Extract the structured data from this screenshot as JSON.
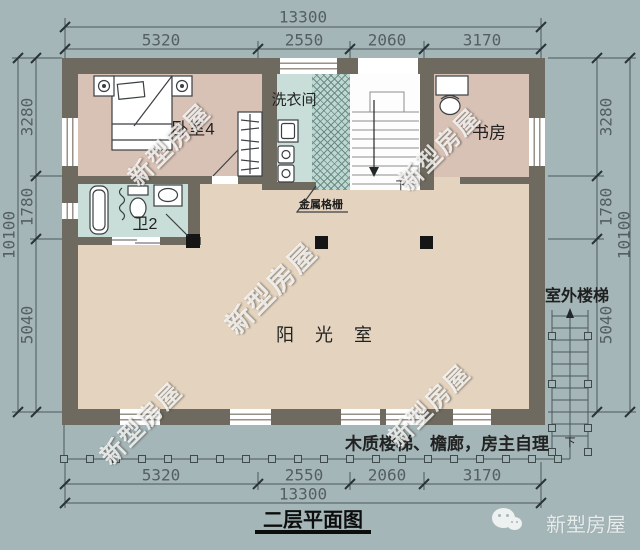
{
  "title": "二层平面图",
  "watermark": "新型房屋",
  "logo": {
    "name": "新型房屋"
  },
  "colors": {
    "background": "#a4b6b8",
    "wall": "#6f6a5f",
    "floor_bedroom_study": "#d8c1b5",
    "floor_bath_laundry": "#c9ded8",
    "floor_sunroom": "#e4d4bf",
    "dimension_text": "#545f63",
    "label_text": "#1f1f1f",
    "watermark_text": "#ffffff",
    "column_black": "#151515"
  },
  "rooms": {
    "bedroom": "卧室4",
    "laundry": "洗衣间",
    "study": "书房",
    "bathroom": "卫2",
    "sunroom": "阳 光 室"
  },
  "annotations": {
    "metal_grille": "金属格栅",
    "outdoor_stairs": "室外楼梯",
    "stairs_down": "下",
    "outdoor_stairs_down": "下",
    "note": "木质楼梯、檐廊，房主自理"
  },
  "dimensions": {
    "top": {
      "total": "13300",
      "segments": [
        "5320",
        "2550",
        "2060",
        "3170"
      ]
    },
    "bottom": {
      "total": "13300",
      "segments": [
        "5320",
        "2550",
        "2060",
        "3170"
      ]
    },
    "left": {
      "total": "10100",
      "segments": [
        "3280",
        "1780",
        "5040"
      ]
    },
    "right": {
      "total": "10100",
      "segments": [
        "3280",
        "1780",
        "5040"
      ]
    }
  }
}
